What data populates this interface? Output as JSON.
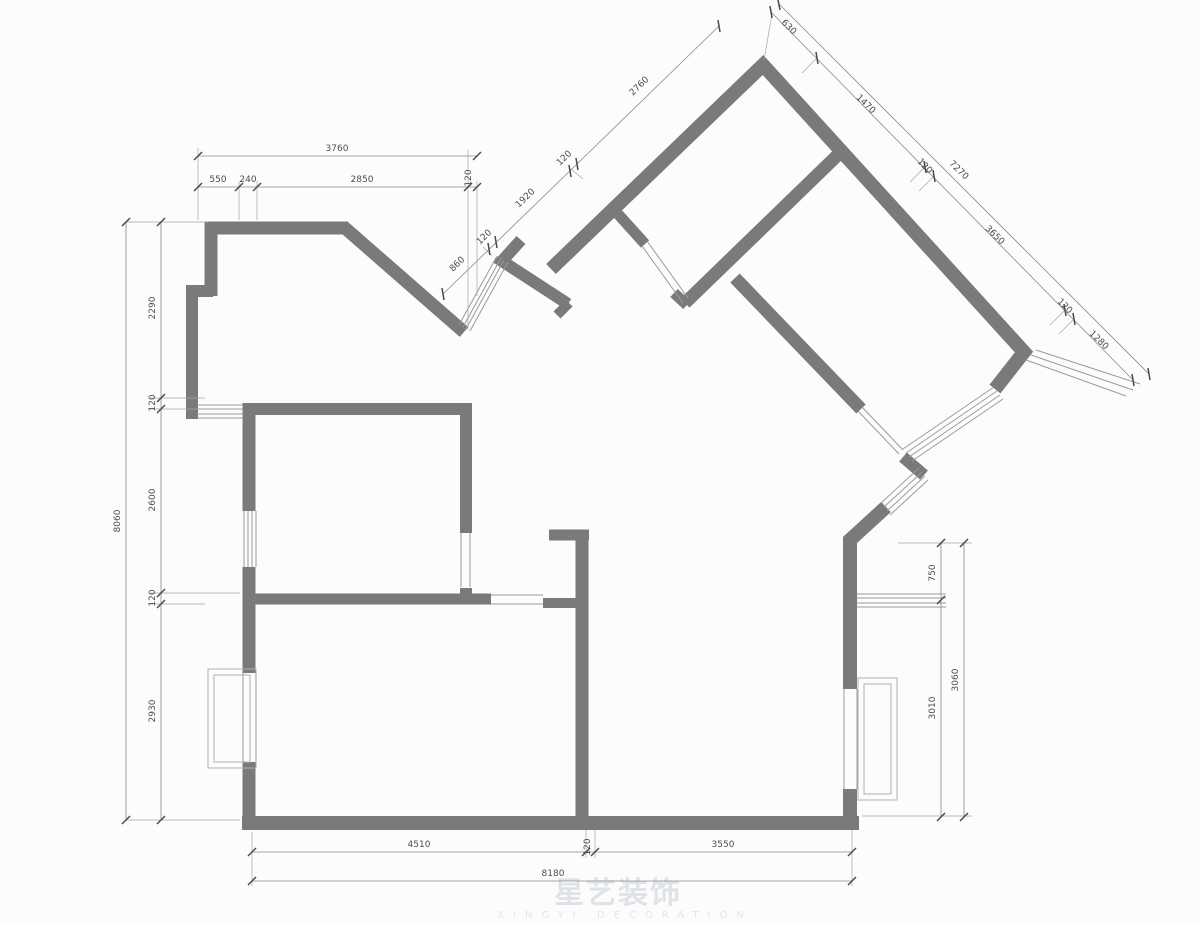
{
  "watermark": {
    "cjk": "星艺装饰",
    "latin": "XINGYI DECORATION"
  },
  "dims": {
    "top_left": {
      "overall": "3760",
      "parts": [
        "550",
        "240",
        "2850",
        "120"
      ]
    },
    "left": {
      "overall": "8060",
      "parts": [
        "2290",
        "120",
        "2600",
        "120",
        "2930"
      ]
    },
    "entry": {
      "overall": "2760",
      "parts": [
        "860",
        "120",
        "1920",
        "120"
      ]
    },
    "top_right": {
      "overall": "7270",
      "parts": [
        "630",
        "1470",
        "120",
        "3650",
        "120",
        "1280"
      ]
    },
    "right": {
      "outer": "3060",
      "inner": [
        "750",
        "3010"
      ]
    },
    "bottom": {
      "overall": "8180",
      "parts": [
        "4510",
        "120",
        "3550"
      ]
    }
  }
}
